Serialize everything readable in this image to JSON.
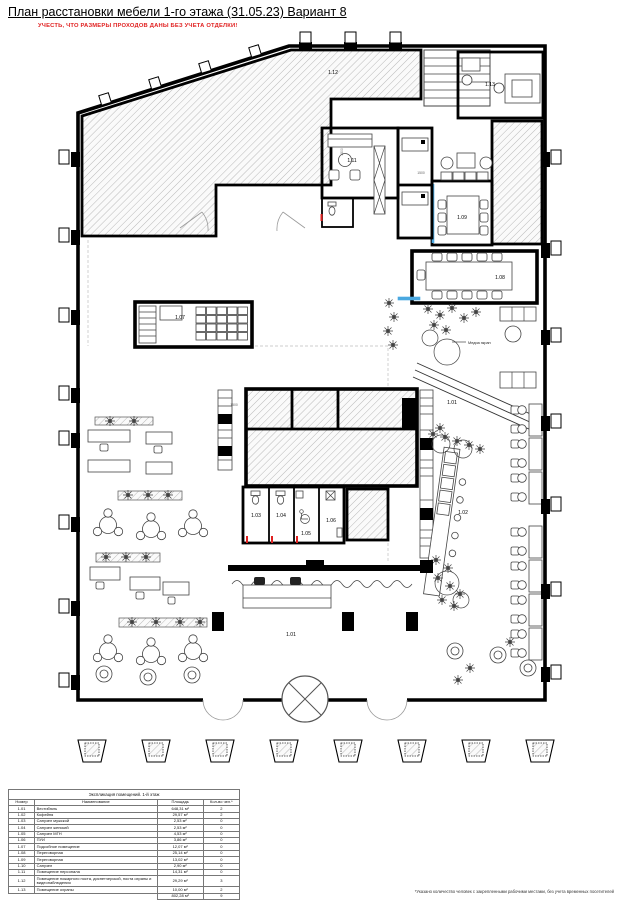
{
  "page": {
    "title": "План расстановки мебели 1-го этажа (31.05.23) Вариант 8",
    "warning": "УЧЕСТЬ, ЧТО РАЗМЕРЫ ПРОХОДОВ ДАНЫ БЕЗ УЧЕТА ОТДЕЛКИ!",
    "footnote": "*Указано количество человек с закрепленными рабочими местами, без учета временных посетителей"
  },
  "colors": {
    "warning_red": "#e02020",
    "glass_blue": "#4aa8e0",
    "wall_black": "#000000",
    "hatch_gray": "#b9b9b9"
  },
  "plan": {
    "labels": {
      "r112": "1.12",
      "r113": "1.13",
      "r111": "1.11",
      "r109": "1.09",
      "r108": "1.08",
      "r107": "1.07",
      "r101a": "1.01",
      "r102": "1.02",
      "r103": "1.03",
      "r104": "1.04",
      "r105": "1.05",
      "r106": "1.06",
      "r101b": "1.01"
    },
    "media_label": "Медиа экран",
    "dims": [
      "1500",
      "1500",
      "1500"
    ]
  },
  "table": {
    "title": "Экспликация помещений. 1-й этаж",
    "headers": [
      "Номер",
      "Наименование",
      "Площадь",
      "Кол-во чел.*"
    ],
    "rows": [
      [
        "1.01",
        "Вестибюль",
        "648,31 м²",
        "2"
      ],
      [
        "1.02",
        "Кофейня",
        "29,57 м²",
        "2"
      ],
      [
        "1.03",
        "Санузел мужской",
        "2,53 м²",
        "0"
      ],
      [
        "1.04",
        "Санузел женский",
        "2,53 м²",
        "0"
      ],
      [
        "1.05",
        "Санузел МГН",
        "4,53 м²",
        "0"
      ],
      [
        "1.06",
        "ПУИ",
        "3,86 м²",
        "0"
      ],
      [
        "1.07",
        "Подсобное помещение",
        "12,07 м²",
        "0"
      ],
      [
        "1.08",
        "Переговорная",
        "25,14 м²",
        "0"
      ],
      [
        "1.09",
        "Переговорная",
        "13,02 м²",
        "0"
      ],
      [
        "1.10",
        "Санузел",
        "2,90 м²",
        "0"
      ],
      [
        "1.11",
        "Помещение персонала",
        "14,31 м²",
        "0"
      ],
      [
        "1.12",
        "Помещение пожарного поста, диспетчерской, поста охраны и видеонаблюдения",
        "29,29 м²",
        "3"
      ],
      [
        "1.13",
        "Помещение охраны",
        "10,00 м²",
        "2"
      ]
    ],
    "total_area": "802,28 м²",
    "total_people": "9"
  }
}
